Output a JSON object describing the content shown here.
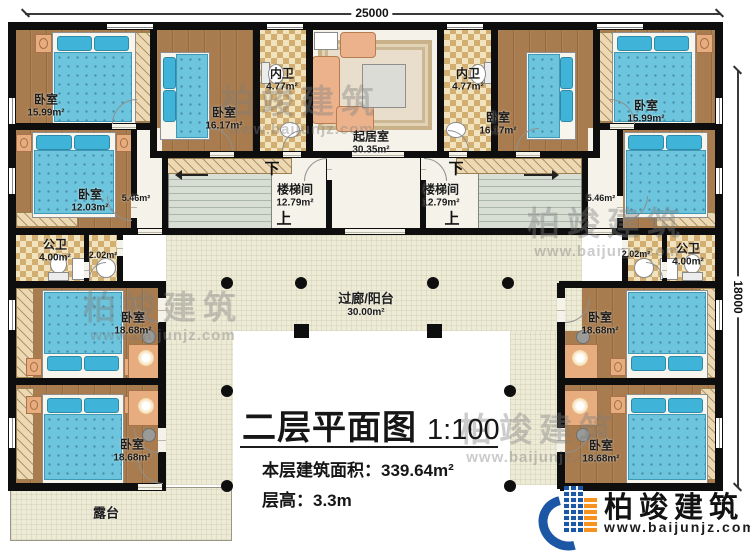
{
  "dimensions": {
    "top": "25000",
    "right": "18000"
  },
  "rooms": {
    "bedroom_tl": {
      "name": "卧室",
      "area": "15.99m²"
    },
    "bedroom_tl2": {
      "name": "卧室",
      "area": "16.17m²"
    },
    "bath_inner_left": {
      "name": "内卫",
      "area": "4.77m²"
    },
    "living": {
      "name": "起居室",
      "area": "30.35m²"
    },
    "bath_inner_right": {
      "name": "内卫",
      "area": "4.77m²"
    },
    "bedroom_tr2": {
      "name": "卧室",
      "area": "16.17m²"
    },
    "bedroom_tr": {
      "name": "卧室",
      "area": "15.99m²"
    },
    "bedroom_ml": {
      "name": "卧室",
      "area": "12.03m²"
    },
    "corridor_left": {
      "area": "5.46m²"
    },
    "corridor_right": {
      "area": "5.46m²"
    },
    "stair_left": {
      "name": "楼梯间",
      "area": "12.79m²",
      "down": "下",
      "up": "上"
    },
    "stair_right": {
      "name": "楼梯间",
      "area": "12.79m²",
      "down": "下",
      "up": "上"
    },
    "pub_bath_left": {
      "name": "公卫",
      "area": "4.00m²"
    },
    "hall_left": {
      "area": "2.02m²"
    },
    "hall_right": {
      "area": "2.02m²"
    },
    "pub_bath_right": {
      "name": "公卫",
      "area": "4.00m²"
    },
    "bedroom_lu": {
      "name": "卧室",
      "area": "18.68m²"
    },
    "bedroom_ll": {
      "name": "卧室",
      "area": "18.68m²"
    },
    "bedroom_ru": {
      "name": "卧室",
      "area": "18.68m²"
    },
    "bedroom_rl": {
      "name": "卧室",
      "area": "18.68m²"
    },
    "balcony": {
      "name": "过廊/阳台",
      "area": "30.00m²"
    },
    "terrace": {
      "name": "露台"
    }
  },
  "title": {
    "main": "二层平面图",
    "scale": "1:100",
    "area_label": "本层建筑面积：",
    "area_value": "339.64m²",
    "floor_height_label": "层高：",
    "floor_height_value": "3.3m"
  },
  "brand": {
    "name": "柏竣建筑",
    "site": "www.baijunjz.com"
  },
  "watermark": {
    "name": "柏竣建筑",
    "site": "www.baijunjz.com"
  },
  "colors": {
    "wall": "#0e0e0e",
    "wood_floor": "#a87c4e",
    "bath_check": "#d2ae71",
    "bed_blue": "#6cc5dc",
    "stair_green": "#d8ded4",
    "courtyard_cream": "#edead6",
    "brand_blue": "#1b57a5",
    "brand_orange": "#f6921e"
  }
}
